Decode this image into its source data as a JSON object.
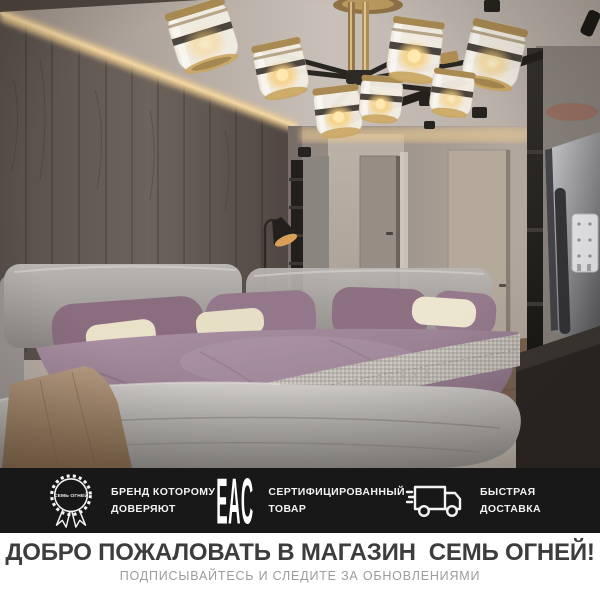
{
  "badges_bar": {
    "background": "#181818",
    "items": [
      {
        "icon": "brand-seal-icon",
        "seal_text": "СЕМЬ ОГНЕЙ",
        "line1": "БРЕНД КОТОРОМУ",
        "line2": "ДОВЕРЯЮТ"
      },
      {
        "icon": "eac-certification-icon",
        "eac_label": "EAC",
        "line1": "СЕРТИФИЦИРОВАННЫЙ",
        "line2": "ТОВАР"
      },
      {
        "icon": "delivery-truck-icon",
        "line1": "БЫСТРАЯ",
        "line2": "ДОСТАВКА"
      }
    ]
  },
  "footer": {
    "title": "ДОБРО ПОЖАЛОВАТЬ В МАГАЗИН  СЕМЬ ОГНЕЙ!",
    "subtitle": "ПОДПИСЫВАЙТЕСЬ И СЛЕДИТЕ ЗА ОБНОВЛЕНИЯМИ",
    "title_color": "#3d3d3d",
    "subtitle_color": "#9c9c9c"
  },
  "photo": {
    "accent_brass": "#b08d55",
    "accent_warm_glow": "#f0cf9b",
    "wood_wall": "#5f5751",
    "duvet_mauve": "#9a8093",
    "pillow_cream": "#ece5c9"
  }
}
